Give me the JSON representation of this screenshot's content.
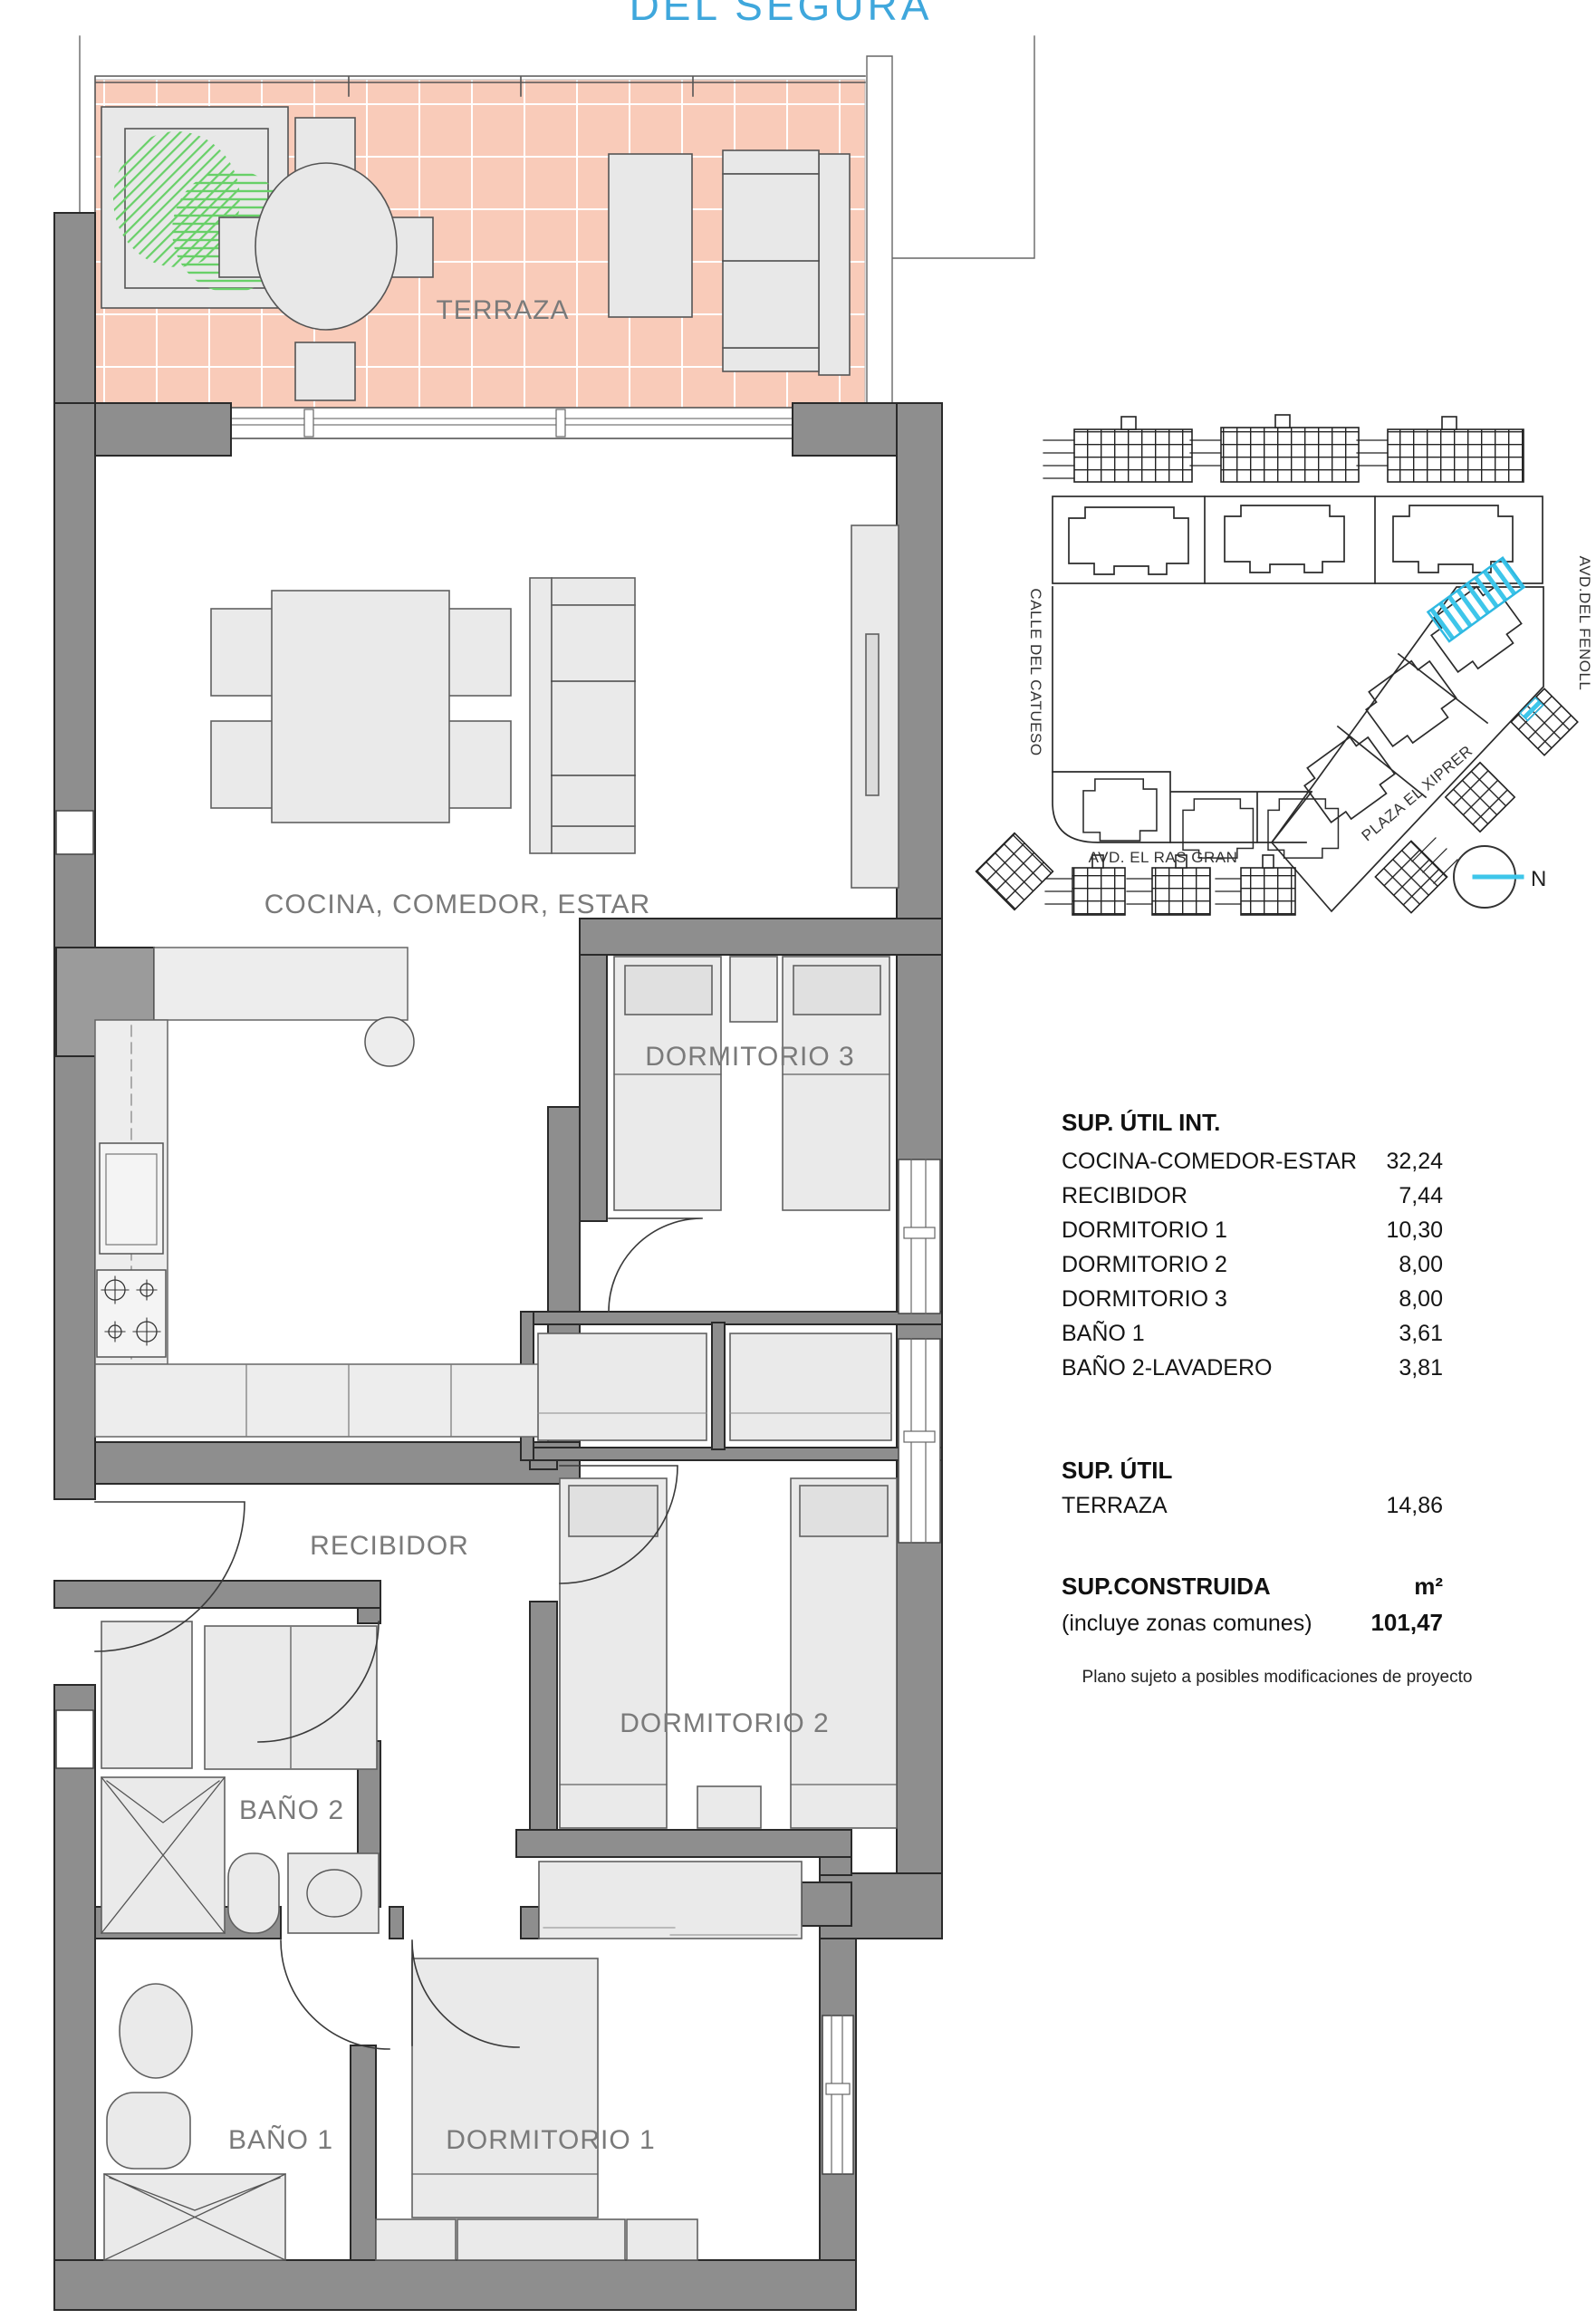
{
  "title": "DEL SEGURA",
  "plan": {
    "rooms": {
      "terraza": "TERRAZA",
      "cocina": "COCINA, COMEDOR, ESTAR",
      "dormitorio3": "DORMITORIO 3",
      "recibidor": "RECIBIDOR",
      "dormitorio2": "DORMITORIO 2",
      "bano2": "BAÑO 2",
      "bano1": "BAÑO 1",
      "dormitorio1": "DORMITORIO 1"
    }
  },
  "site_plan": {
    "streets": {
      "left": "CALLE DEL CATUESO",
      "right": "AVD.DEL FENOLL",
      "diagonal": "PLAZA EL XIPRER",
      "bottom": "AVD. EL RAS GRAN"
    },
    "north_label": "N"
  },
  "area_table": {
    "util_int": {
      "heading": "SUP. ÚTIL INT.",
      "rows": [
        {
          "label": "COCINA-COMEDOR-ESTAR",
          "value": "32,24"
        },
        {
          "label": "RECIBIDOR",
          "value": "7,44"
        },
        {
          "label": "DORMITORIO 1",
          "value": "10,30"
        },
        {
          "label": "DORMITORIO 2",
          "value": "8,00"
        },
        {
          "label": "DORMITORIO 3",
          "value": "8,00"
        },
        {
          "label": "BAÑO 1",
          "value": "3,61"
        },
        {
          "label": "BAÑO 2-LAVADERO",
          "value": "3,81"
        }
      ]
    },
    "util": {
      "heading": "SUP. ÚTIL",
      "rows": [
        {
          "label": "TERRAZA",
          "value": "14,86"
        }
      ]
    },
    "construida": {
      "heading": "SUP.CONSTRUIDA",
      "unit": "m²",
      "note": "(incluye zonas comunes)",
      "value": "101,47"
    },
    "disclaimer": "Plano sujeto a posibles modificaciones de proyecto"
  },
  "colors": {
    "accent_blue": "#3fa7dc",
    "terrace_tile": "#f9cbb9",
    "wall_gray": "#8e8e8e",
    "highlight_cyan": "#3ec6ea",
    "plant_green": "#68d068"
  }
}
